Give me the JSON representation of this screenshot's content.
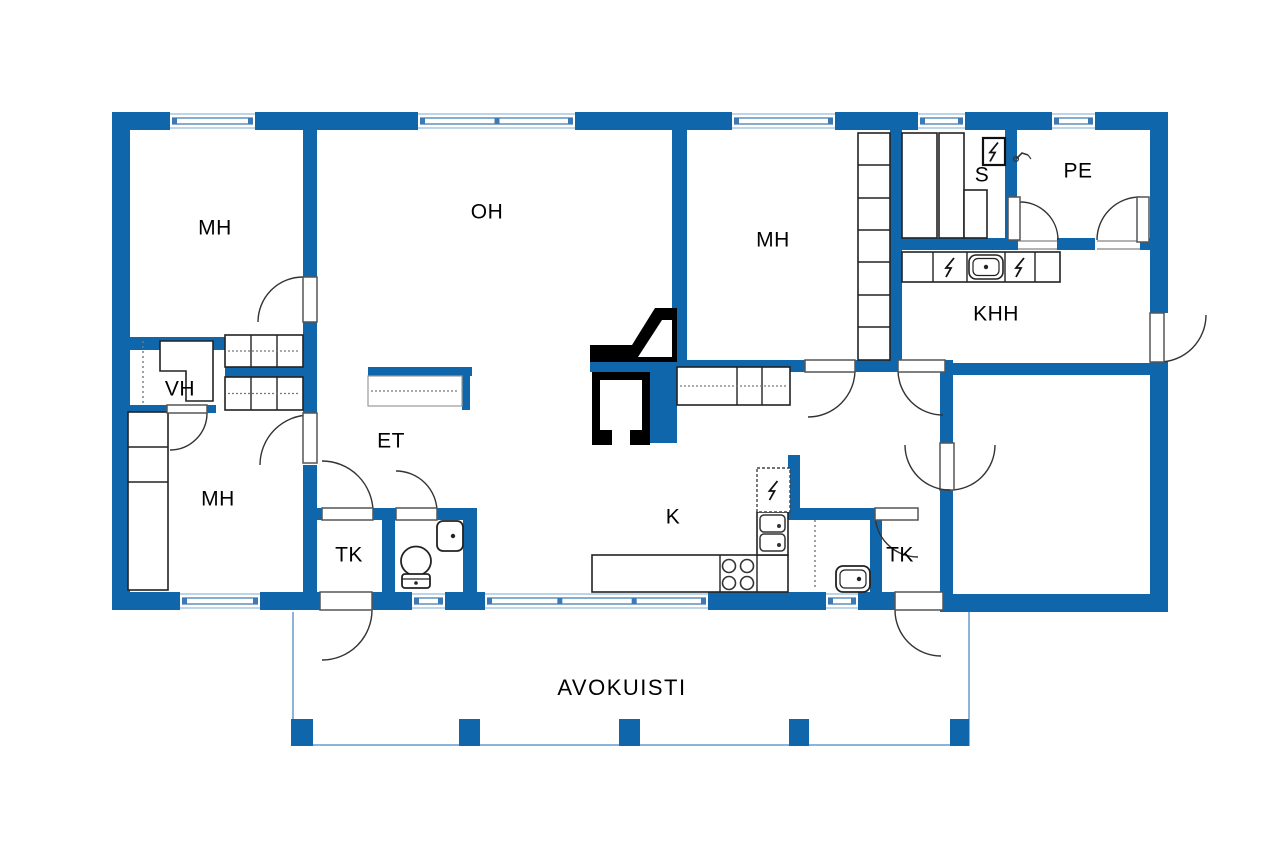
{
  "plan": {
    "canvas": {
      "w": 1280,
      "h": 847
    },
    "colors": {
      "wall": "#1066ab",
      "window_edge": "#a9c7e2",
      "window_mid": "#3d7ab5",
      "outline": "#1a1a1a",
      "fixture_line": "#222222",
      "dash": "#777777",
      "door_arc": "#333333",
      "door_leaf_stroke": "#555555",
      "threshold": "#999999",
      "porch_line": "#8cb4d8",
      "black": "#000000",
      "label": "#000000",
      "bg": "#ffffff"
    },
    "labels": [
      {
        "id": "mh-nw",
        "text": "MH",
        "x": 215,
        "y": 229,
        "size": 21
      },
      {
        "id": "oh",
        "text": "OH",
        "x": 487,
        "y": 213,
        "size": 21
      },
      {
        "id": "mh-n",
        "text": "MH",
        "x": 773,
        "y": 241,
        "size": 21
      },
      {
        "id": "s",
        "text": "S",
        "x": 982,
        "y": 176,
        "size": 21
      },
      {
        "id": "pe",
        "text": "PE",
        "x": 1078,
        "y": 172,
        "size": 21
      },
      {
        "id": "khh",
        "text": "KHH",
        "x": 996,
        "y": 315,
        "size": 21
      },
      {
        "id": "vh",
        "text": "VH",
        "x": 180,
        "y": 390,
        "size": 21
      },
      {
        "id": "et",
        "text": "ET",
        "x": 391,
        "y": 442,
        "size": 21
      },
      {
        "id": "mh-sw",
        "text": "MH",
        "x": 218,
        "y": 500,
        "size": 21
      },
      {
        "id": "tk-w",
        "text": "TK",
        "x": 349,
        "y": 556,
        "size": 21
      },
      {
        "id": "k",
        "text": "K",
        "x": 673,
        "y": 518,
        "size": 21
      },
      {
        "id": "tk-e",
        "text": "TK",
        "x": 900,
        "y": 556,
        "size": 21
      },
      {
        "id": "avokuisti",
        "text": "AVOKUISTI",
        "x": 622,
        "y": 689,
        "size": 22,
        "spacing": 1.5
      }
    ],
    "walls": [
      [
        112,
        112,
        1056,
        18
      ],
      [
        112,
        130,
        18,
        480
      ],
      [
        1150,
        130,
        18,
        183
      ],
      [
        1150,
        362,
        18,
        250
      ],
      [
        112,
        592,
        208,
        18
      ],
      [
        372,
        592,
        523,
        18
      ],
      [
        943,
        594,
        225,
        18
      ],
      [
        303,
        130,
        14,
        147
      ],
      [
        303,
        322,
        14,
        91
      ],
      [
        303,
        465,
        14,
        127
      ],
      [
        112,
        337,
        113,
        13
      ],
      [
        225,
        367,
        78,
        10
      ],
      [
        112,
        405,
        104,
        8
      ],
      [
        672,
        130,
        15,
        232
      ],
      [
        890,
        130,
        12,
        233
      ],
      [
        1005,
        130,
        12,
        113
      ],
      [
        902,
        238,
        116,
        12
      ],
      [
        1057,
        238,
        38,
        12
      ],
      [
        1140,
        238,
        10,
        12
      ],
      [
        677,
        360,
        128,
        12
      ],
      [
        855,
        360,
        45,
        12
      ],
      [
        945,
        360,
        8,
        12
      ],
      [
        788,
        455,
        12,
        65
      ],
      [
        785,
        508,
        90,
        12
      ],
      [
        870,
        520,
        12,
        72
      ],
      [
        382,
        510,
        13,
        82
      ],
      [
        463,
        510,
        14,
        82
      ],
      [
        317,
        508,
        5,
        12
      ],
      [
        373,
        508,
        23,
        12
      ],
      [
        437,
        508,
        40,
        12
      ],
      [
        953,
        363,
        209,
        12
      ],
      [
        940,
        363,
        13,
        80
      ],
      [
        940,
        490,
        13,
        122
      ],
      [
        590,
        362,
        60,
        10
      ],
      [
        650,
        362,
        27,
        81
      ],
      [
        368,
        367,
        104,
        9
      ],
      [
        462,
        376,
        8,
        34
      ]
    ],
    "windows": {
      "top": {
        "y": 112,
        "h": 18,
        "spans": [
          [
            170,
            85
          ],
          [
            418,
            157
          ],
          [
            732,
            103
          ],
          [
            918,
            47
          ],
          [
            1052,
            43
          ]
        ]
      },
      "bottom": {
        "y": 592,
        "h": 18,
        "spans": [
          [
            180,
            80
          ],
          [
            412,
            33
          ],
          [
            485,
            223
          ],
          [
            826,
            32
          ]
        ]
      }
    },
    "doors": [
      {
        "name": "mh-nw-door",
        "leaf": [
          303,
          277,
          14,
          45
        ],
        "arc": [
          303,
          322,
          45,
          180,
          270
        ]
      },
      {
        "name": "mh-sw-door",
        "leaf": [
          303,
          413,
          14,
          50
        ],
        "arc": [
          310,
          465,
          50,
          180,
          270
        ]
      },
      {
        "name": "vh-door",
        "leaf": [
          167,
          405,
          40,
          8
        ],
        "arc": [
          170,
          413,
          37,
          0,
          90
        ]
      },
      {
        "name": "tk-w-door",
        "leaf": [
          322,
          508,
          51,
          12
        ],
        "arc": [
          322,
          512,
          51,
          0,
          -90
        ]
      },
      {
        "name": "wc-door",
        "leaf": [
          396,
          508,
          41,
          12
        ],
        "arc": [
          396,
          512,
          41,
          0,
          -90
        ]
      },
      {
        "name": "porch-door-west",
        "leaf": [
          320,
          592,
          52,
          18
        ],
        "arc": [
          322,
          610,
          50,
          0,
          90
        ]
      },
      {
        "name": "porch-door-east",
        "leaf": [
          895,
          592,
          48,
          18
        ],
        "arc": [
          941,
          610,
          46,
          180,
          90
        ]
      },
      {
        "name": "mh-n-door",
        "leaf": [
          805,
          360,
          50,
          12
        ],
        "arc": [
          808,
          370,
          47,
          0,
          90
        ]
      },
      {
        "name": "khh-hall-door",
        "leaf": [
          898,
          360,
          47,
          12
        ],
        "arc": [
          943,
          370,
          45,
          180,
          90
        ]
      },
      {
        "name": "sauna-door",
        "leaf": [
          1008,
          197,
          12,
          43
        ],
        "arc": [
          1020,
          240,
          38,
          270,
          360
        ]
      },
      {
        "name": "pe-door",
        "leaf": [
          1137,
          197,
          12,
          45
        ],
        "arc": [
          1140,
          240,
          43,
          270,
          180
        ]
      },
      {
        "name": "entry-door-east",
        "leaf": [
          1150,
          313,
          14,
          49
        ],
        "arc": [
          1159,
          315,
          47,
          90,
          0
        ]
      },
      {
        "name": "tk-e-door",
        "leaf": [
          875,
          508,
          43,
          12
        ],
        "arc": [
          918,
          514,
          43,
          180,
          90
        ]
      },
      {
        "name": "bigroom-door",
        "leaf": [
          940,
          443,
          14,
          47
        ],
        "arc": [
          950,
          445,
          45,
          90,
          0
        ]
      },
      {
        "name": "bigroom-door-arc2",
        "leaf": null,
        "arc": [
          950,
          445,
          45,
          90,
          180
        ]
      }
    ],
    "thresholds": [
      [
        1018,
        241,
        39
      ],
      [
        1097,
        241,
        43
      ]
    ],
    "fireplace": {
      "flue": "590,345 632,345 655,308 677,308 677,362 590,362",
      "flue_white": "638,357 662,320 672,320 672,357",
      "box": [
        592,
        372,
        58,
        73
      ],
      "box_inner": [
        600,
        380,
        42,
        50
      ],
      "box_notch": [
        612,
        430,
        18,
        15
      ]
    },
    "fixtures": [
      {
        "type": "cabinet",
        "name": "closet-row-upper",
        "x": 225,
        "y": 335,
        "w": 78,
        "h": 32,
        "vdiv": [
          251,
          277
        ],
        "dash": true
      },
      {
        "type": "cabinet",
        "name": "closet-row-lower",
        "x": 225,
        "y": 377,
        "w": 78,
        "h": 33,
        "vdiv": [
          251,
          277
        ],
        "dash": true
      },
      {
        "type": "cabinet",
        "name": "closet-col-mh-sw",
        "x": 128,
        "y": 412,
        "w": 40,
        "h": 178,
        "hdiv": [
          447,
          482
        ]
      },
      {
        "type": "cabinet",
        "name": "closet-col-mh-n",
        "x": 858,
        "y": 133,
        "w": 32,
        "h": 227,
        "hdiv": [
          165,
          198,
          230,
          262,
          295,
          327
        ]
      },
      {
        "type": "cabinet",
        "name": "hall-cabinet",
        "x": 677,
        "y": 367,
        "w": 113,
        "h": 38,
        "vdiv": [
          737,
          762
        ],
        "dash": true
      },
      {
        "type": "cabinet",
        "name": "khh-counter",
        "x": 902,
        "y": 252,
        "w": 158,
        "h": 30,
        "vdiv": [
          933,
          967,
          1005,
          1035
        ]
      },
      {
        "type": "cabinet",
        "name": "kitchen-counter",
        "x": 592,
        "y": 555,
        "w": 196,
        "h": 37,
        "vdiv": [
          720,
          757
        ]
      },
      {
        "type": "bench",
        "name": "sauna-bench-1",
        "x": 902,
        "y": 133,
        "w": 35,
        "h": 105
      },
      {
        "type": "bench",
        "name": "sauna-bench-2",
        "x": 939,
        "y": 133,
        "w": 25,
        "h": 105
      },
      {
        "type": "bench",
        "name": "sauna-step",
        "x": 964,
        "y": 190,
        "w": 23,
        "h": 48
      },
      {
        "type": "lshelf",
        "name": "vh-shelf",
        "points": "160,341 213,341 213,401 186,401 186,371 160,371"
      },
      {
        "type": "etshelf",
        "name": "et-shelf",
        "x": 368,
        "y": 376,
        "w": 94,
        "h": 30
      },
      {
        "type": "dashline",
        "name": "vh-depth-line",
        "x1": 143,
        "y1": 341,
        "x2": 143,
        "y2": 403
      },
      {
        "type": "dashline",
        "name": "alcove-depth-line",
        "x1": 815,
        "y1": 520,
        "x2": 815,
        "y2": 590
      },
      {
        "type": "burners",
        "name": "stove-burners",
        "centers": [
          [
            729,
            566
          ],
          [
            747,
            566
          ],
          [
            729,
            583
          ],
          [
            747,
            583
          ]
        ],
        "r": 6.5
      },
      {
        "type": "dsink",
        "name": "kitchen-double-sink",
        "x": 757,
        "y": 512,
        "w": 31,
        "h": 43
      },
      {
        "type": "fridge",
        "name": "fridge",
        "x": 757,
        "y": 468,
        "w": 33,
        "h": 44
      },
      {
        "type": "boltbox",
        "name": "sauna-stove",
        "x": 983,
        "y": 138,
        "w": 22,
        "h": 27
      },
      {
        "type": "bolt",
        "name": "khh-appliance-1",
        "cx": 950,
        "cy": 267
      },
      {
        "type": "bolt",
        "name": "khh-appliance-2",
        "cx": 1020,
        "cy": 267
      },
      {
        "type": "sink",
        "name": "khh-sink",
        "x": 969,
        "y": 255,
        "w": 34,
        "h": 24
      },
      {
        "type": "basin",
        "name": "alcove-washbasin",
        "x": 836,
        "y": 566,
        "w": 34,
        "h": 26
      },
      {
        "type": "wcbasin",
        "name": "wc-washbasin",
        "x": 437,
        "y": 521,
        "w": 26,
        "h": 30
      },
      {
        "type": "toilet",
        "name": "wc-toilet",
        "cx": 416,
        "cy": 561
      },
      {
        "type": "shower",
        "name": "pe-shower",
        "x": 1018,
        "y": 150
      }
    ],
    "porch": {
      "outline": [
        [
          293,
          612
        ],
        [
          293,
          745
        ],
        [
          969,
          745
        ],
        [
          969,
          612
        ]
      ],
      "pillars": [
        [
          291,
          719,
          22,
          27
        ],
        [
          459,
          719,
          21,
          27
        ],
        [
          619,
          719,
          21,
          27
        ],
        [
          789,
          719,
          20,
          27
        ],
        [
          950,
          719,
          19,
          27
        ]
      ]
    }
  }
}
